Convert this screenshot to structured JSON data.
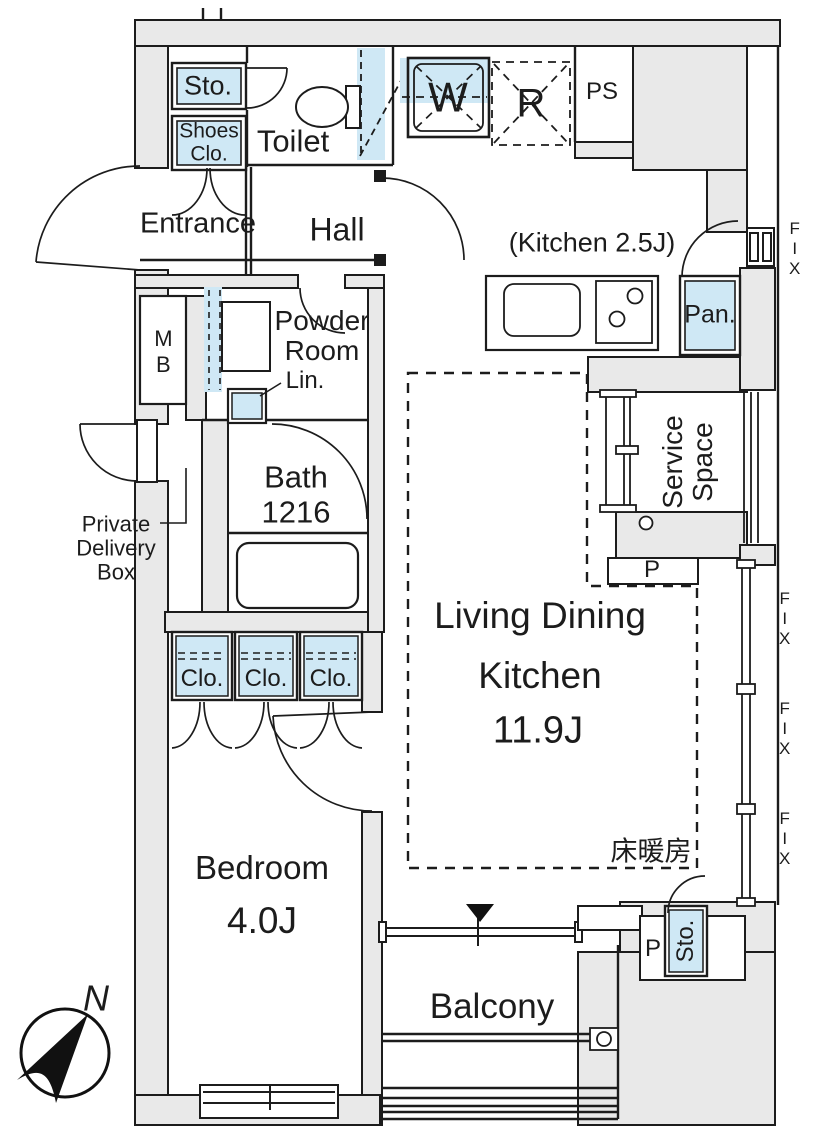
{
  "title": "apartment-floor-plan",
  "colors": {
    "wall_fill": "#e9e9e9",
    "highlight_blue": "#cfe8f5",
    "line": "#1c1c1c"
  },
  "rooms": {
    "entrance": "Entrance",
    "hall": "Hall",
    "toilet": "Toilet",
    "kitchen": "(Kitchen 2.5J)",
    "powder_room": "Powder Room",
    "bath": "Bath",
    "bath_size": "1216",
    "living_line1": "Living Dining",
    "living_line2": "Kitchen",
    "living_size": "11.9J",
    "bedroom": "Bedroom",
    "bedroom_size": "4.0J",
    "balcony": "Balcony",
    "service_space": "Service Space",
    "floor_heating": "床暖房"
  },
  "labels": {
    "storage": "Sto.",
    "shoes_closet": "Shoes Clo.",
    "washer": "W",
    "fridge": "R",
    "pipe_shaft": "PS",
    "pantry": "Pan.",
    "meter_box": "MB",
    "linen": "Lin.",
    "closet": "Clo.",
    "private_delivery_box": "Private Delivery Box",
    "pole": "P",
    "fix_window": "FIX",
    "north": "N"
  }
}
